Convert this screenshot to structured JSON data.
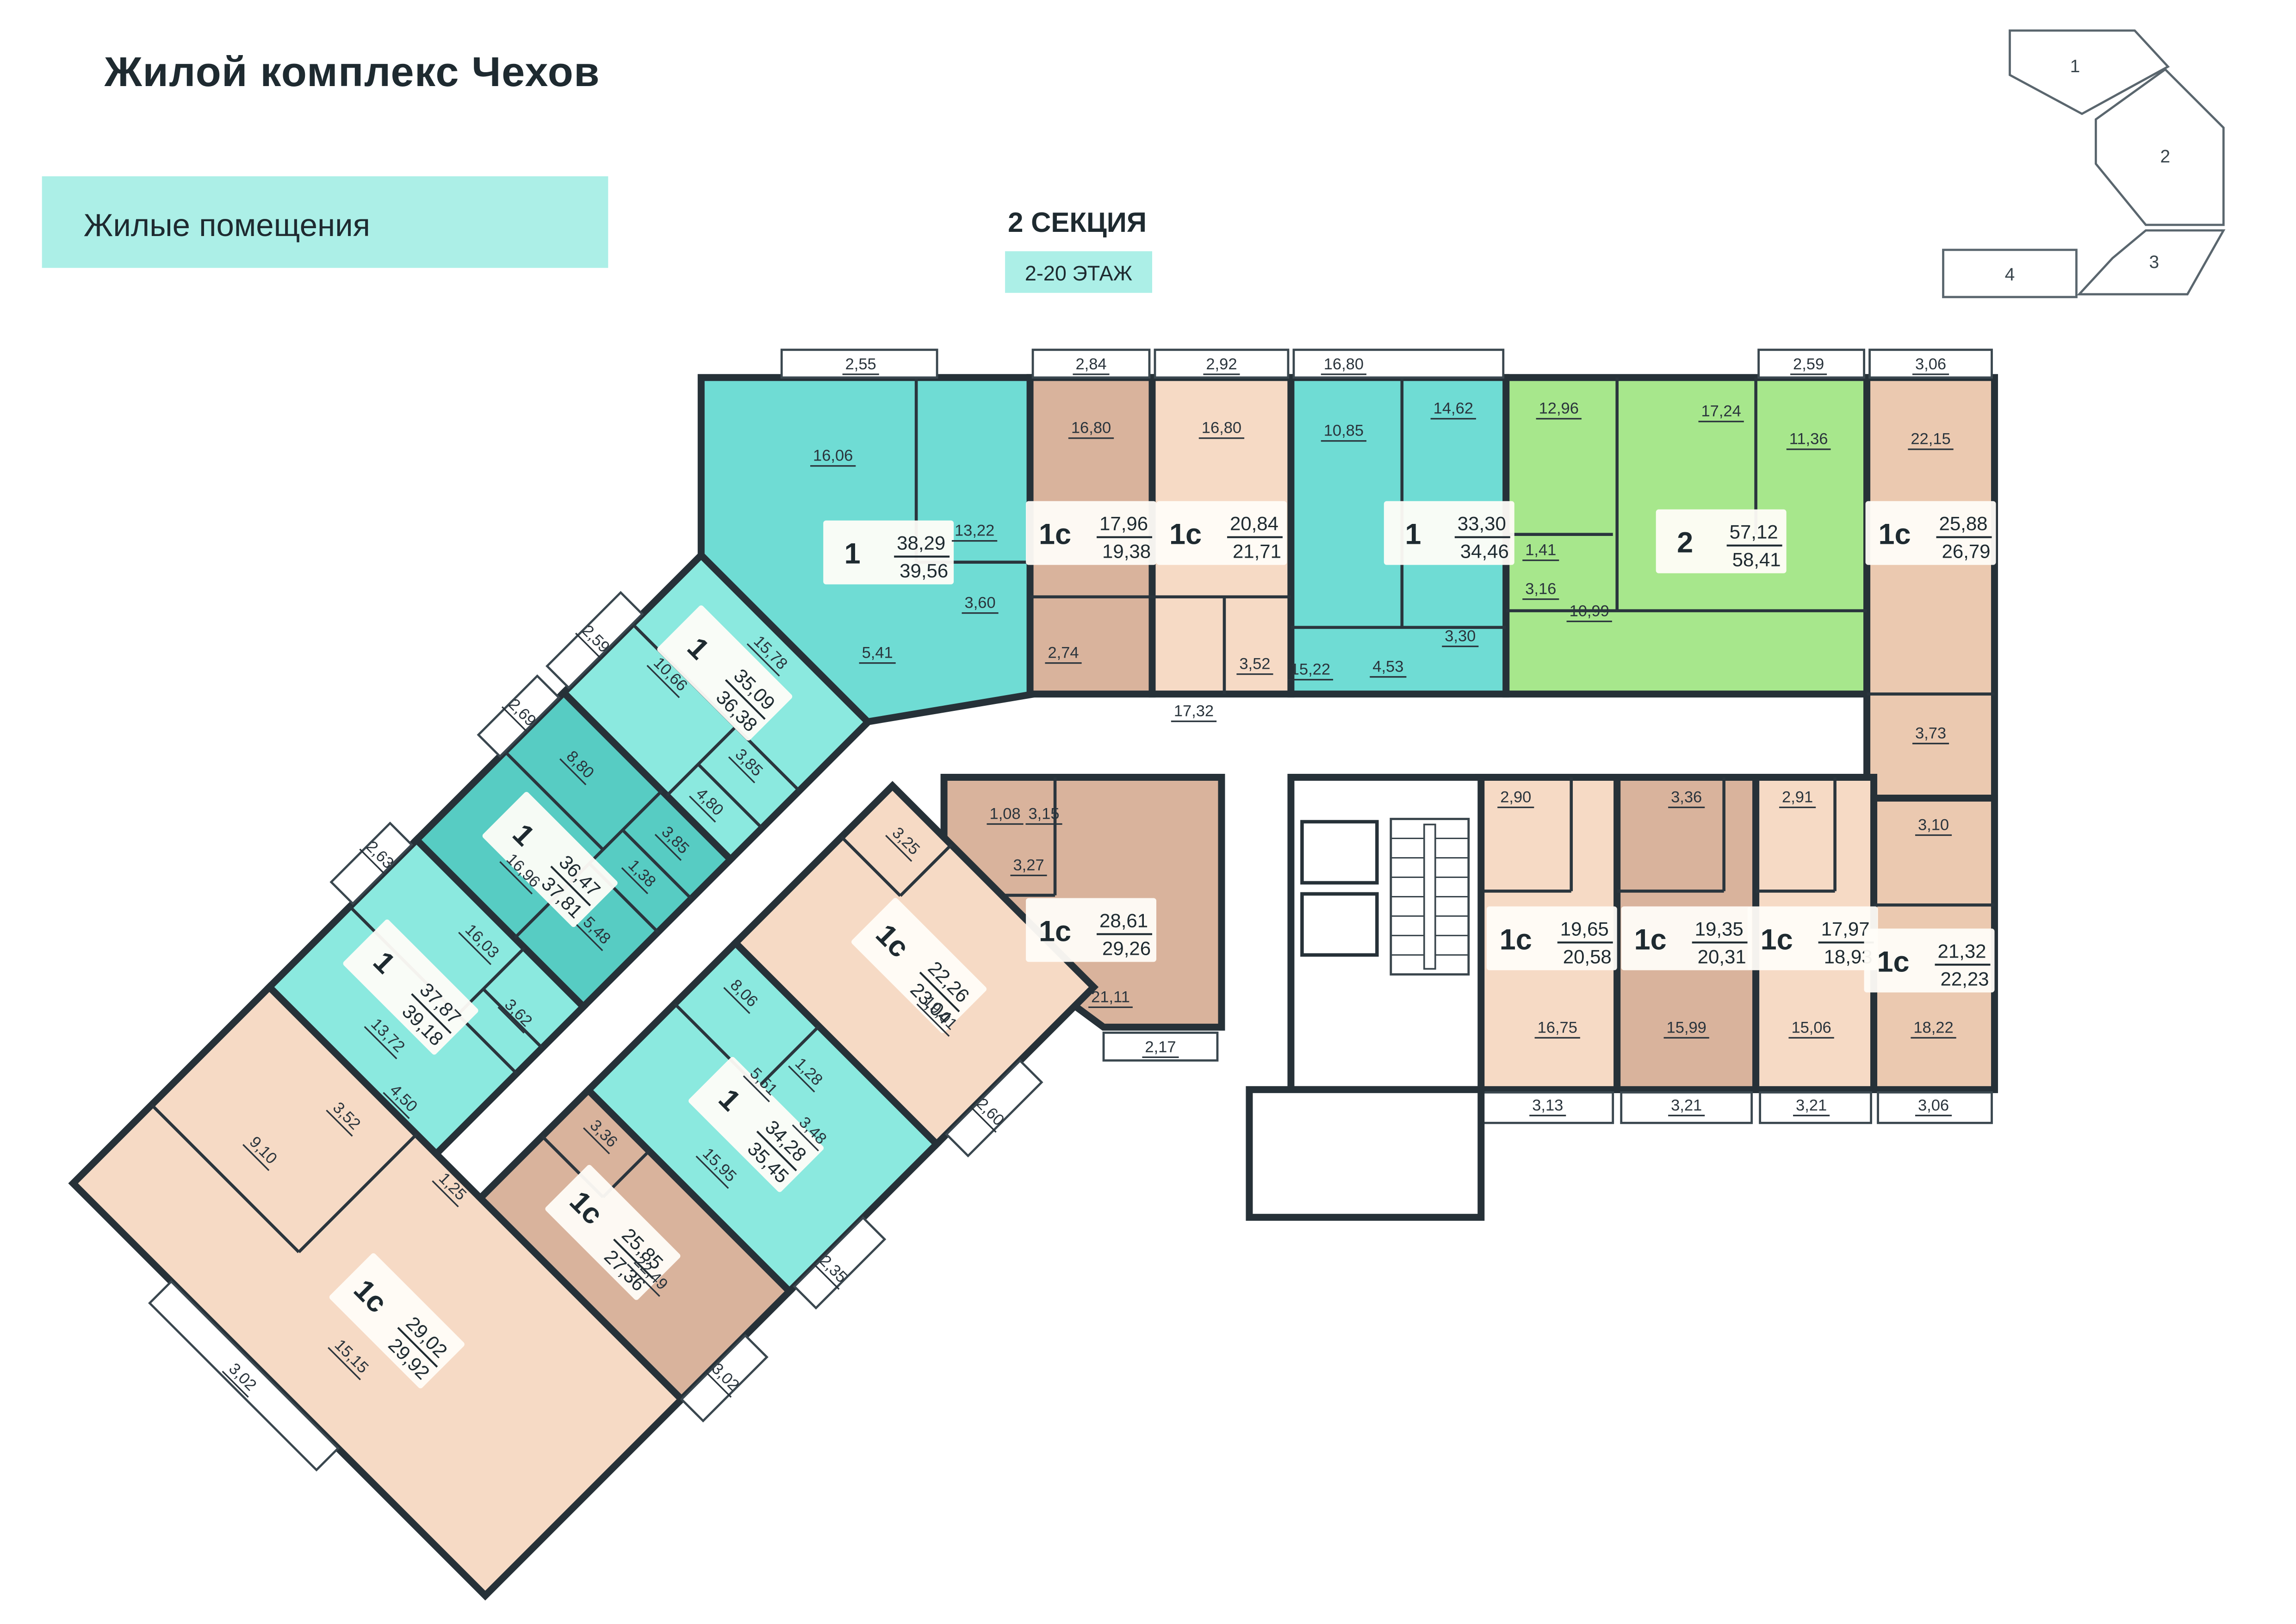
{
  "header": {
    "title": "Жилой комплекс Чехов",
    "legend_label": "Жилые помещения",
    "section_title": "2 СЕКЦИЯ",
    "floors_label": "2-20 ЭТАЖ"
  },
  "minimap": {
    "active_color": "#ACEFE7",
    "sections": [
      {
        "label": "1",
        "active": false
      },
      {
        "label": "2",
        "active": true
      },
      {
        "label": "3",
        "active": false
      },
      {
        "label": "4",
        "active": false
      }
    ]
  },
  "colors": {
    "wall": "#263138",
    "teal_light": "#8BE9DF",
    "teal_mid": "#6FDCD4",
    "teal_dark": "#57CCC3",
    "green": "#A7E78C",
    "peach": "#F6DAC5",
    "tan_mid": "#EBC9B0",
    "tan_dark": "#D9B39C",
    "label_bg": "#FFFDF8",
    "legend_bg": "#ACEFE7",
    "dim_text": "#2A343C"
  },
  "apartments": [
    {
      "id": "a1",
      "type": "1",
      "area_net": "38,29",
      "area_total": "39,56",
      "color": "teal_mid"
    },
    {
      "id": "a2",
      "type": "1с",
      "area_net": "17,96",
      "area_total": "19,38",
      "color": "tan_dark"
    },
    {
      "id": "a3",
      "type": "1с",
      "area_net": "20,84",
      "area_total": "21,71",
      "color": "peach"
    },
    {
      "id": "a4",
      "type": "1",
      "area_net": "33,30",
      "area_total": "34,46",
      "color": "teal_mid"
    },
    {
      "id": "a5",
      "type": "2",
      "area_net": "57,12",
      "area_total": "58,41",
      "color": "green"
    },
    {
      "id": "a6",
      "type": "1с",
      "area_net": "25,88",
      "area_total": "26,79",
      "color": "tan_mid"
    },
    {
      "id": "a14",
      "type": "1с",
      "area_net": "28,61",
      "area_total": "29,26",
      "color": "tan_dark"
    },
    {
      "id": "a15",
      "type": "1с",
      "area_net": "19,65",
      "area_total": "20,58",
      "color": "peach"
    },
    {
      "id": "a16",
      "type": "1с",
      "area_net": "19,35",
      "area_total": "20,31",
      "color": "tan_dark"
    },
    {
      "id": "a17",
      "type": "1с",
      "area_net": "17,97",
      "area_total": "18,93",
      "color": "peach"
    },
    {
      "id": "a18",
      "type": "1с",
      "area_net": "21,32",
      "area_total": "22,23",
      "color": "tan_mid"
    },
    {
      "id": "a7",
      "type": "1",
      "area_net": "35,09",
      "area_total": "36,38",
      "color": "teal_light"
    },
    {
      "id": "a8",
      "type": "1",
      "area_net": "36,47",
      "area_total": "37,81",
      "color": "teal_dark"
    },
    {
      "id": "a9",
      "type": "1",
      "area_net": "37,87",
      "area_total": "39,18",
      "color": "teal_light"
    },
    {
      "id": "a10",
      "type": "1с",
      "area_net": "29,02",
      "area_total": "29,92",
      "color": "peach"
    },
    {
      "id": "a13",
      "type": "1с",
      "area_net": "22,26",
      "area_total": "23,04",
      "color": "peach"
    },
    {
      "id": "a12",
      "type": "1",
      "area_net": "34,28",
      "area_total": "35,45",
      "color": "teal_light"
    },
    {
      "id": "a11",
      "type": "1с",
      "area_net": "25,85",
      "area_total": "27,36",
      "color": "tan_dark"
    }
  ],
  "plan": {
    "dim_labels": [
      "2,55",
      "16,06",
      "13,22",
      "3,60",
      "5,41",
      "2,84",
      "16,80",
      "2,74",
      "2,92",
      "16,80",
      "3,52",
      "16,80",
      "10,85",
      "14,62",
      "4,53",
      "3,30",
      "12,96",
      "17,24",
      "2,59",
      "11,36",
      "1,41",
      "3,16",
      "10,99",
      "3,06",
      "22,15",
      "3,73",
      "1,08",
      "3,15",
      "3,27",
      "21,11",
      "2,17",
      "2,90",
      "16,75",
      "3,13",
      "3,36",
      "15,99",
      "3,21",
      "2,91",
      "15,06",
      "3,21",
      "3,10",
      "18,22",
      "3,06",
      "15,22",
      "17,32",
      "15,78",
      "2,59",
      "10,66",
      "3,85",
      "4,80",
      "2,69",
      "8,80",
      "3,85",
      "1,38",
      "5,48",
      "16,96",
      "2,63",
      "16,03",
      "3,62",
      "13,72",
      "4,50",
      "1,25",
      "3,52",
      "9,10",
      "15,15",
      "3,02",
      "3,25",
      "19,01",
      "2,60",
      "8,06",
      "1,28",
      "5,51",
      "3,48",
      "15,95",
      "2,35",
      "3,36",
      "22,49",
      "3,02"
    ]
  }
}
